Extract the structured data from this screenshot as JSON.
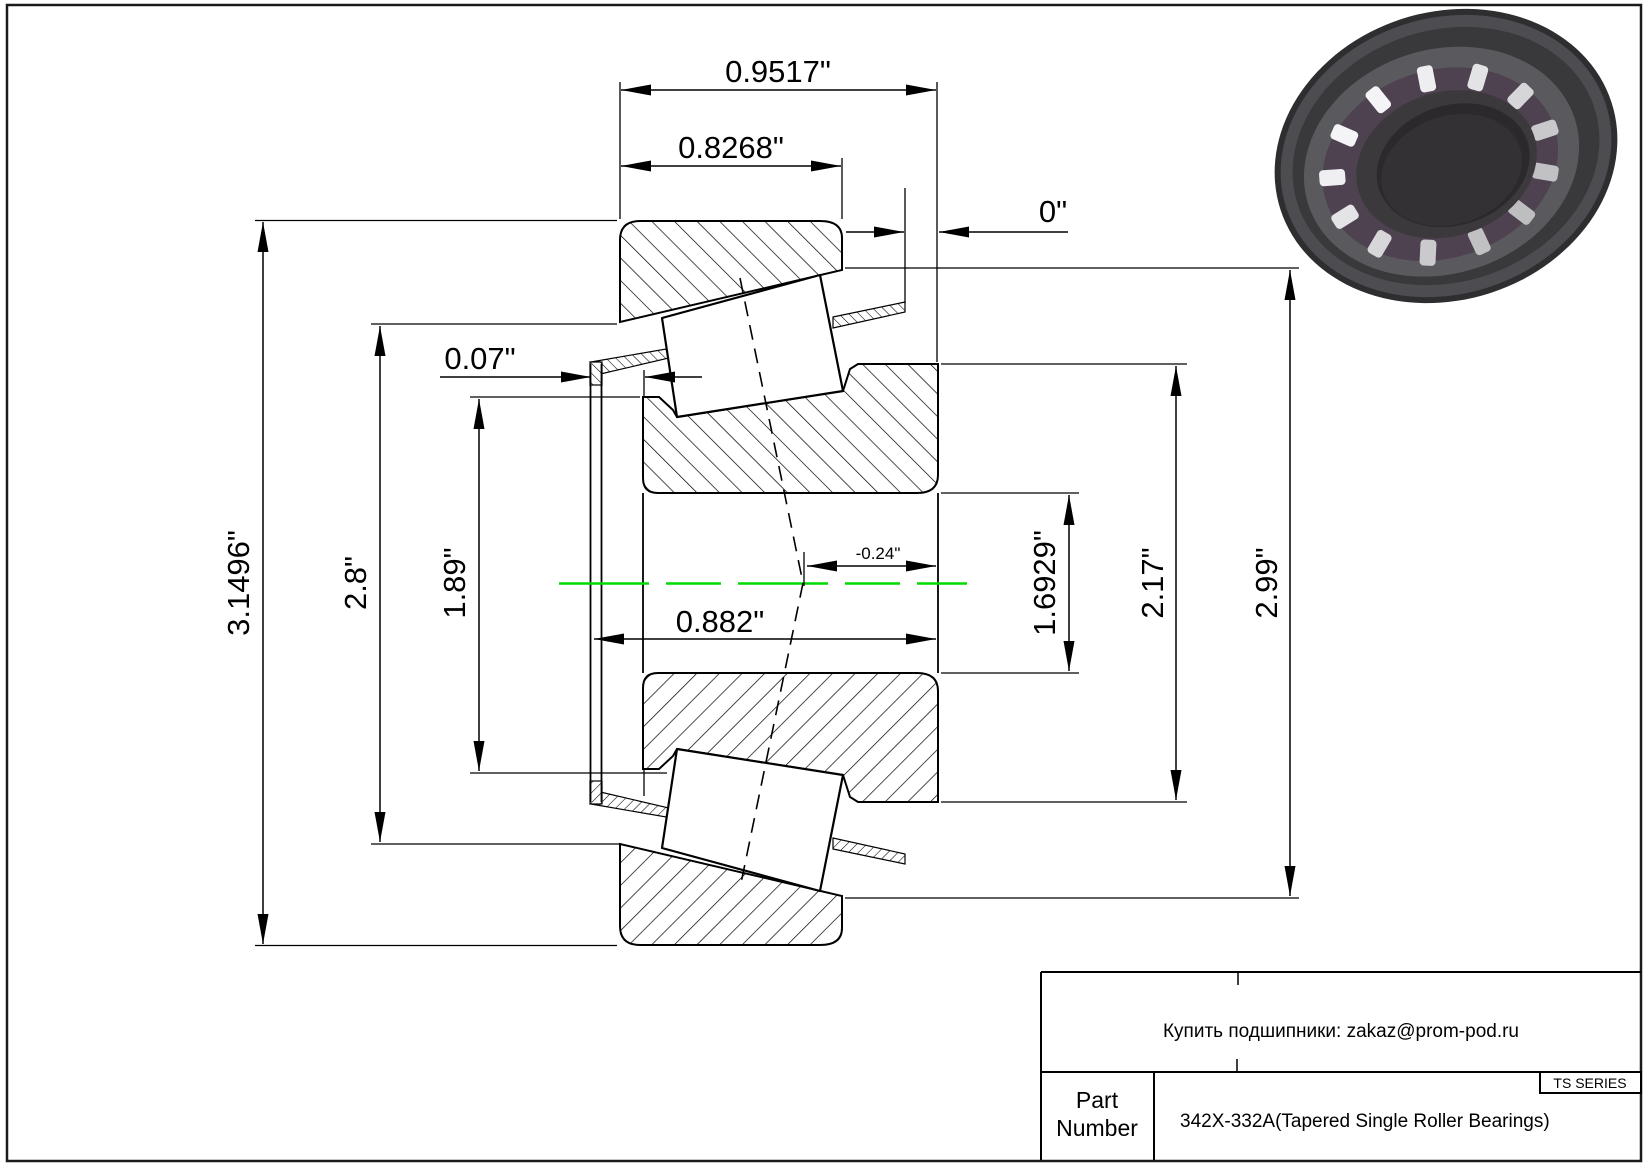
{
  "dims": {
    "overall_width": "0.9517\"",
    "cup_width": "0.8268\"",
    "stickout": "0\"",
    "cage_lip": "0.07\"",
    "cone_width": "0.882\"",
    "effective_center": "-0.24\"",
    "housing_od": "3.1496\"",
    "outer_shoulder": "2.8\"",
    "inner_shoulder": "1.89\"",
    "bore": "1.6929\"",
    "cone_back_od": "2.17\"",
    "cup_od": "2.99\""
  },
  "title_block": {
    "supplier_note": "Купить подшипники: zakaz@prom-pod.ru",
    "series": "TS SERIES",
    "part_label_line1": "Part",
    "part_label_line2": "Number",
    "part_value": "342X-332A(Tapered Single Roller Bearings)"
  },
  "colors": {
    "centerline_green": "#00DC00",
    "line": "#000000"
  }
}
